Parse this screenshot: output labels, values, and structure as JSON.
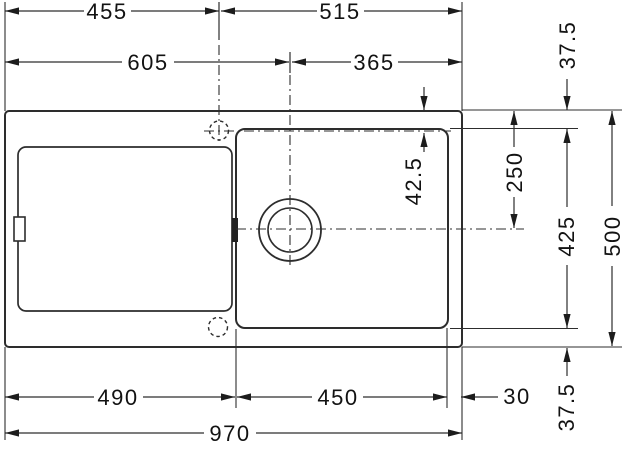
{
  "drawing": {
    "background_color": "#ffffff",
    "line_color": "#2d2d2d",
    "text_color": "#121212"
  },
  "dimensions": {
    "top_row": {
      "left": "455",
      "right": "515"
    },
    "second_row": {
      "left": "605",
      "right": "365"
    },
    "bottom_row": {
      "left": "490",
      "middle": "450",
      "right": "30"
    },
    "overall_width": "970",
    "right_column": {
      "top_rim_offset": "37.5",
      "tap_centerline_offset": "42.5",
      "top_to_drain_center": "250",
      "bowl_height": "425",
      "overall_height": "500",
      "bottom_rim_offset": "37.5"
    }
  }
}
